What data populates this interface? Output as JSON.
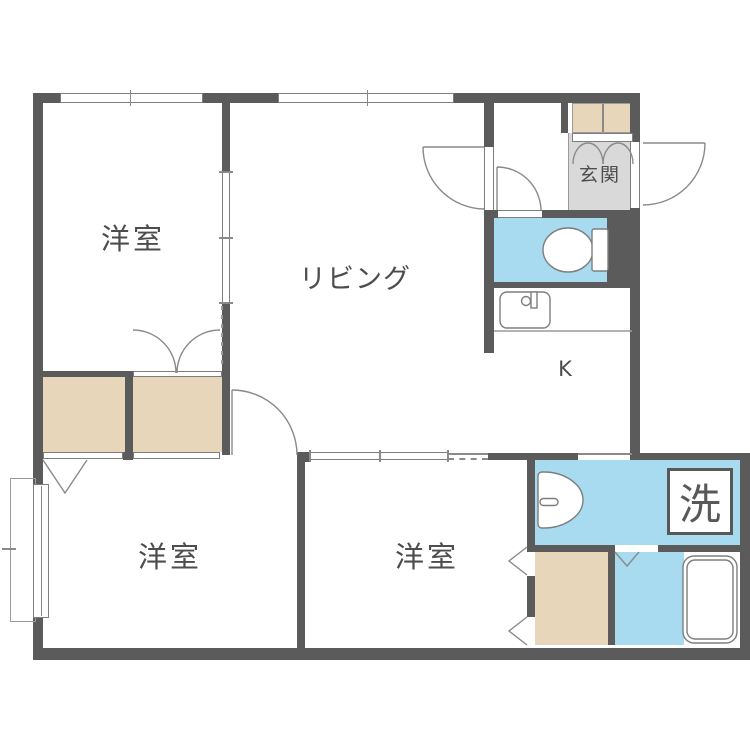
{
  "plan_title": "apartment-floor-plan",
  "rooms": {
    "bedroom_top": {
      "label": "洋室"
    },
    "living": {
      "label": "リビング"
    },
    "bedroom_bottom_left": {
      "label": "洋室"
    },
    "bedroom_bottom_middle": {
      "label": "洋室"
    },
    "entrance": {
      "label": "玄関"
    },
    "kitchen": {
      "label": "K"
    },
    "laundry": {
      "label": "洗"
    }
  },
  "colors": {
    "wall": "#5b5b5b",
    "water_area": "#a8daf0",
    "closet_area": "#e8d6ba",
    "entrance_floor": "#d9d9d9",
    "fixture_line": "#8a8a8a",
    "text": "#4d4d4d"
  }
}
